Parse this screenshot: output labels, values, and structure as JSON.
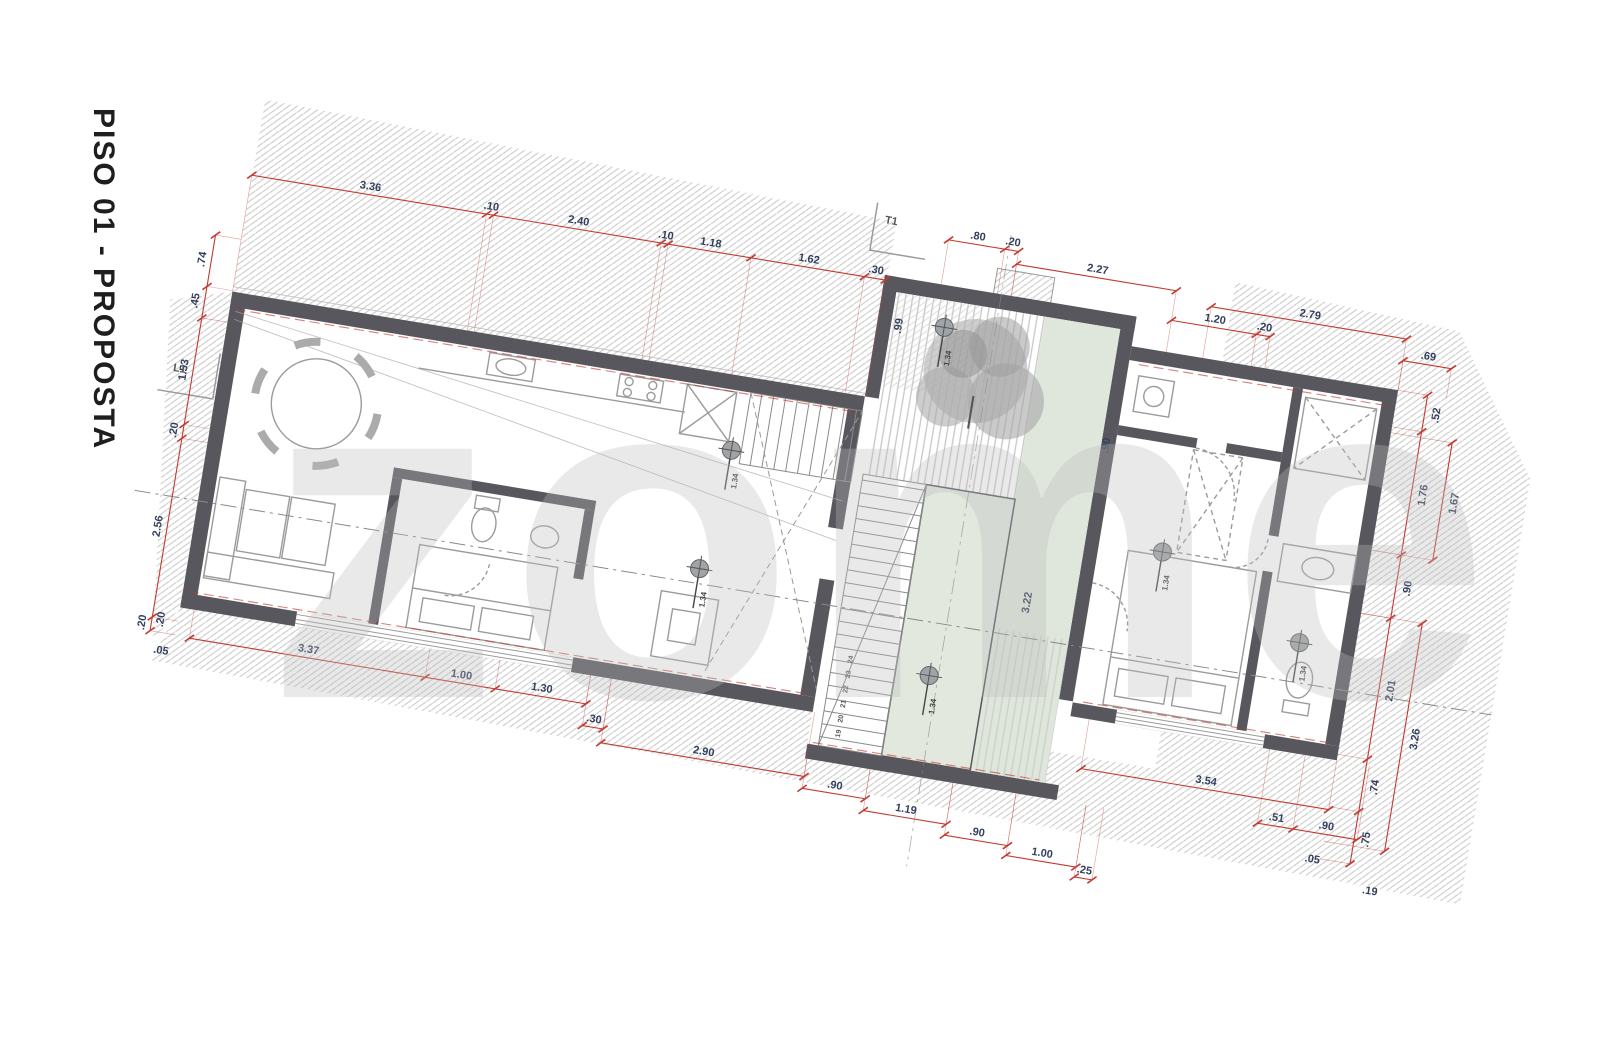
{
  "title": "PISO 01 - PROPOSTA",
  "watermark": "zome",
  "section_markers": {
    "t1": "T1",
    "l1": "L1"
  },
  "level_marker_label": "1.34",
  "colors": {
    "wall": "#57575d",
    "dim": "#c23a30",
    "dim_text": "#33405c",
    "hatch": "#c9c9c9",
    "green": "#e2e8de",
    "green2": "#dfe6db",
    "furniture": "#9b9b9b",
    "axis": "#8a8a8a"
  },
  "plan": {
    "chains": [
      {
        "o": "h",
        "y": 125,
        "x": [
          134,
          372,
          379,
          549,
          556,
          640,
          755,
          776
        ],
        "l": [
          "3.36",
          ".10",
          "2.40",
          ".10",
          "1.18",
          "1.62",
          ".30"
        ],
        "e": 243
      },
      {
        "o": "h",
        "y": 75,
        "x": [
          832,
          889,
          903
        ],
        "l": [
          ".80",
          ".20"
        ],
        "e": 120
      },
      {
        "o": "h",
        "y": 88,
        "x": [
          903,
          1065
        ],
        "l": [
          "2.27"
        ],
        "e": 120
      },
      {
        "o": "h",
        "y": 118,
        "x": [
          1065,
          1151,
          1165
        ],
        "l": [
          "1.20",
          ".20"
        ],
        "e": 150
      },
      {
        "o": "h",
        "y": 98,
        "x": [
          1102,
          1300
        ],
        "l": [
          "2.79"
        ],
        "e": 150
      },
      {
        "o": "h",
        "y": 120,
        "x": [
          1300,
          1349
        ],
        "l": [
          ".69"
        ],
        "e": 150
      },
      {
        "o": "v",
        "x": 108,
        "y": [
          190,
          242,
          274,
          382,
          396,
          577,
          591
        ],
        "l": [
          ".74",
          ".45",
          "1.53",
          ".20",
          "2.56",
          ".20"
        ],
        "e": 134
      },
      {
        "o": "h",
        "y": 592,
        "x": [
          148,
          387,
          458,
          550
        ],
        "l": [
          "3.37",
          "1.00",
          "1.30"
        ],
        "e": 563
      },
      {
        "o": "h",
        "y": 614,
        "x": [
          550,
          571
        ],
        "l": [
          ".30"
        ],
        "e": 563
      },
      {
        "o": "h",
        "y": 628,
        "x": [
          571,
          777
        ],
        "l": [
          "2.90"
        ],
        "e": 563
      },
      {
        "o": "h",
        "y": 640,
        "x": [
          777,
          841
        ],
        "l": [
          ".90"
        ],
        "e": 610
      },
      {
        "o": "h",
        "y": 652,
        "x": [
          841,
          925
        ],
        "l": [
          "1.19"
        ],
        "e": 610
      },
      {
        "o": "h",
        "y": 663,
        "x": [
          925,
          989
        ],
        "l": [
          ".90"
        ],
        "e": 610
      },
      {
        "o": "h",
        "y": 673,
        "x": [
          989,
          1060
        ],
        "l": [
          "1.00"
        ],
        "e": 610
      },
      {
        "o": "h",
        "y": 683,
        "x": [
          1060,
          1078
        ],
        "l": [
          ".25"
        ],
        "e": 610
      },
      {
        "o": "h",
        "y": 575,
        "x": [
          1049,
          1300
        ],
        "l": [
          "3.54"
        ],
        "e": 525
      },
      {
        "o": "h",
        "y": 600,
        "x": [
          1232,
          1268,
          1333
        ],
        "l": [
          ".51",
          ".90"
        ],
        "e": 525
      },
      {
        "o": "v",
        "x": 1330,
        "y": [
          150,
          187,
          312,
          376,
          519,
          572,
          625
        ],
        "l": [
          ".52",
          "1.76",
          ".90",
          "2.01",
          ".74",
          ".75"
        ],
        "e": 1300,
        "s": 1
      },
      {
        "o": "v",
        "x": 1362,
        "y": [
          193,
          312
        ],
        "l": [
          "1.67"
        ],
        "e": 1300,
        "s": 1
      },
      {
        "o": "v",
        "x": 1362,
        "y": [
          376,
          607
        ],
        "l": [
          "3.26"
        ],
        "e": 1300,
        "s": 1
      }
    ],
    "free_labels": [
      {
        "t": ".05",
        "x": 122,
        "y": 612,
        "r": 0
      },
      {
        "t": ".20",
        "x": 120,
        "y": 578,
        "r": -90
      },
      {
        "t": ".05",
        "x": 1292,
        "y": 630,
        "r": 0
      },
      {
        "t": ".19",
        "x": 1354,
        "y": 652,
        "r": 0
      },
      {
        "t": ".99",
        "x": 800,
        "y": 168,
        "r": -90
      },
      {
        "t": "3.22",
        "x": 972,
        "y": 420,
        "r": -90
      },
      {
        "t": ".90",
        "x": 1024,
        "y": 252,
        "r": -90
      }
    ],
    "level_markers": [
      {
        "x": 652,
        "y": 318
      },
      {
        "x": 640,
        "y": 440
      },
      {
        "x": 884,
        "y": 508
      },
      {
        "x": 842,
        "y": 162
      },
      {
        "x": 1094,
        "y": 348
      },
      {
        "x": 1244,
        "y": 415
      }
    ],
    "stair_numbers": [
      {
        "t": "19",
        "x": 806,
        "y": 580
      },
      {
        "t": "20",
        "x": 806,
        "y": 565
      },
      {
        "t": "21",
        "x": 806,
        "y": 550
      },
      {
        "t": "22",
        "x": 806,
        "y": 535
      },
      {
        "t": "23",
        "x": 806,
        "y": 520
      },
      {
        "t": "24",
        "x": 806,
        "y": 505
      }
    ]
  }
}
